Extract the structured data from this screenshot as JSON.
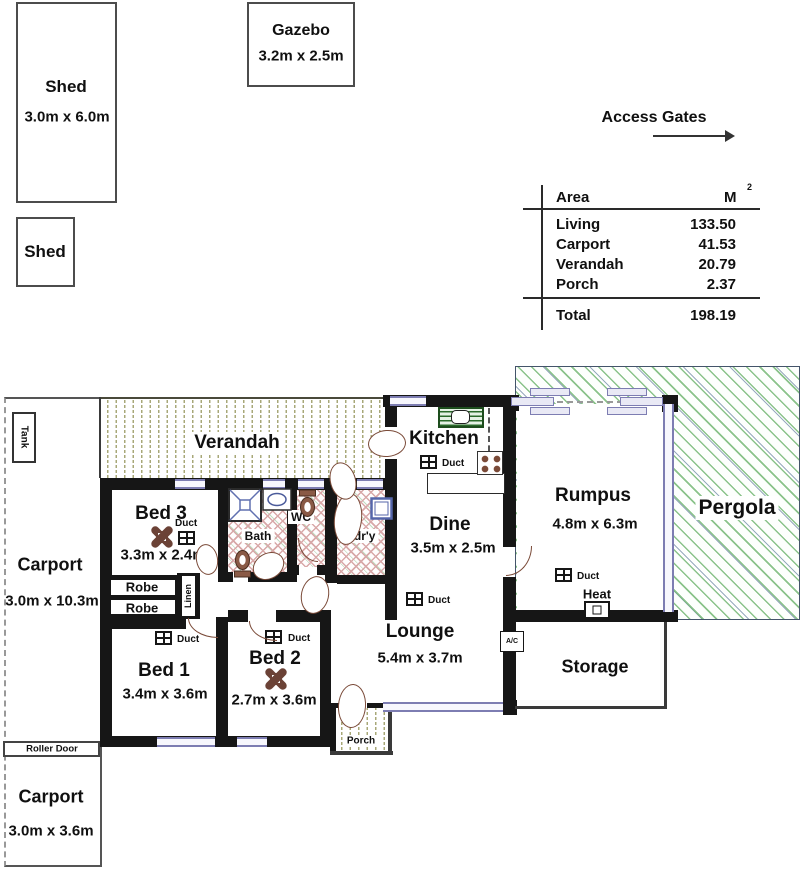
{
  "labels": {
    "access_gates": "Access Gates",
    "duct": "Duct",
    "heat": "Heat",
    "ac": "A/C",
    "robe": "Robe",
    "linen": "Linen",
    "tank": "Tank",
    "roller_door": "Roller Door"
  },
  "outbuildings": {
    "shed_large": {
      "name": "Shed",
      "dims": "3.0m x 6.0m"
    },
    "shed_small": {
      "name": "Shed"
    },
    "gazebo": {
      "name": "Gazebo",
      "dims": "3.2m x 2.5m"
    }
  },
  "area_table": {
    "col_area": "Area",
    "col_unit": "M",
    "col_unit_sup": "2",
    "rows": [
      {
        "name": "Living",
        "value": "133.50"
      },
      {
        "name": "Carport",
        "value": "41.53"
      },
      {
        "name": "Verandah",
        "value": "20.79"
      },
      {
        "name": "Porch",
        "value": "2.37"
      }
    ],
    "total_label": "Total",
    "total_value": "198.19"
  },
  "rooms": {
    "verandah": {
      "name": "Verandah"
    },
    "kitchen": {
      "name": "Kitchen"
    },
    "dine": {
      "name": "Dine",
      "dims": "3.5m x 2.5m"
    },
    "rumpus": {
      "name": "Rumpus",
      "dims": "4.8m x 6.3m"
    },
    "pergola": {
      "name": "Pergola"
    },
    "lounge": {
      "name": "Lounge",
      "dims": "5.4m x 3.7m"
    },
    "storage": {
      "name": "Storage"
    },
    "bed1": {
      "name": "Bed 1",
      "dims": "3.4m x 3.6m"
    },
    "bed2": {
      "name": "Bed 2",
      "dims": "2.7m x 3.6m"
    },
    "bed3": {
      "name": "Bed 3",
      "dims": "3.3m x 2.4m"
    },
    "bath": {
      "name": "Bath"
    },
    "wc": {
      "name": "WC"
    },
    "laundry": {
      "name": "Ldr'y"
    },
    "porch": {
      "name": "Porch"
    },
    "carport_side": {
      "name": "Carport",
      "dims": "3.0m x 10.3m"
    },
    "carport_front": {
      "name": "Carport",
      "dims": "3.0m x 3.6m"
    }
  },
  "colors": {
    "wall": "#161616",
    "window_frame": "#7d7db2",
    "door": "#7a4a38",
    "verandah_hatch": "#a8a878",
    "pergola_hatch": "#6eb46e",
    "wet_area_hatch": "#d8a8a8"
  }
}
